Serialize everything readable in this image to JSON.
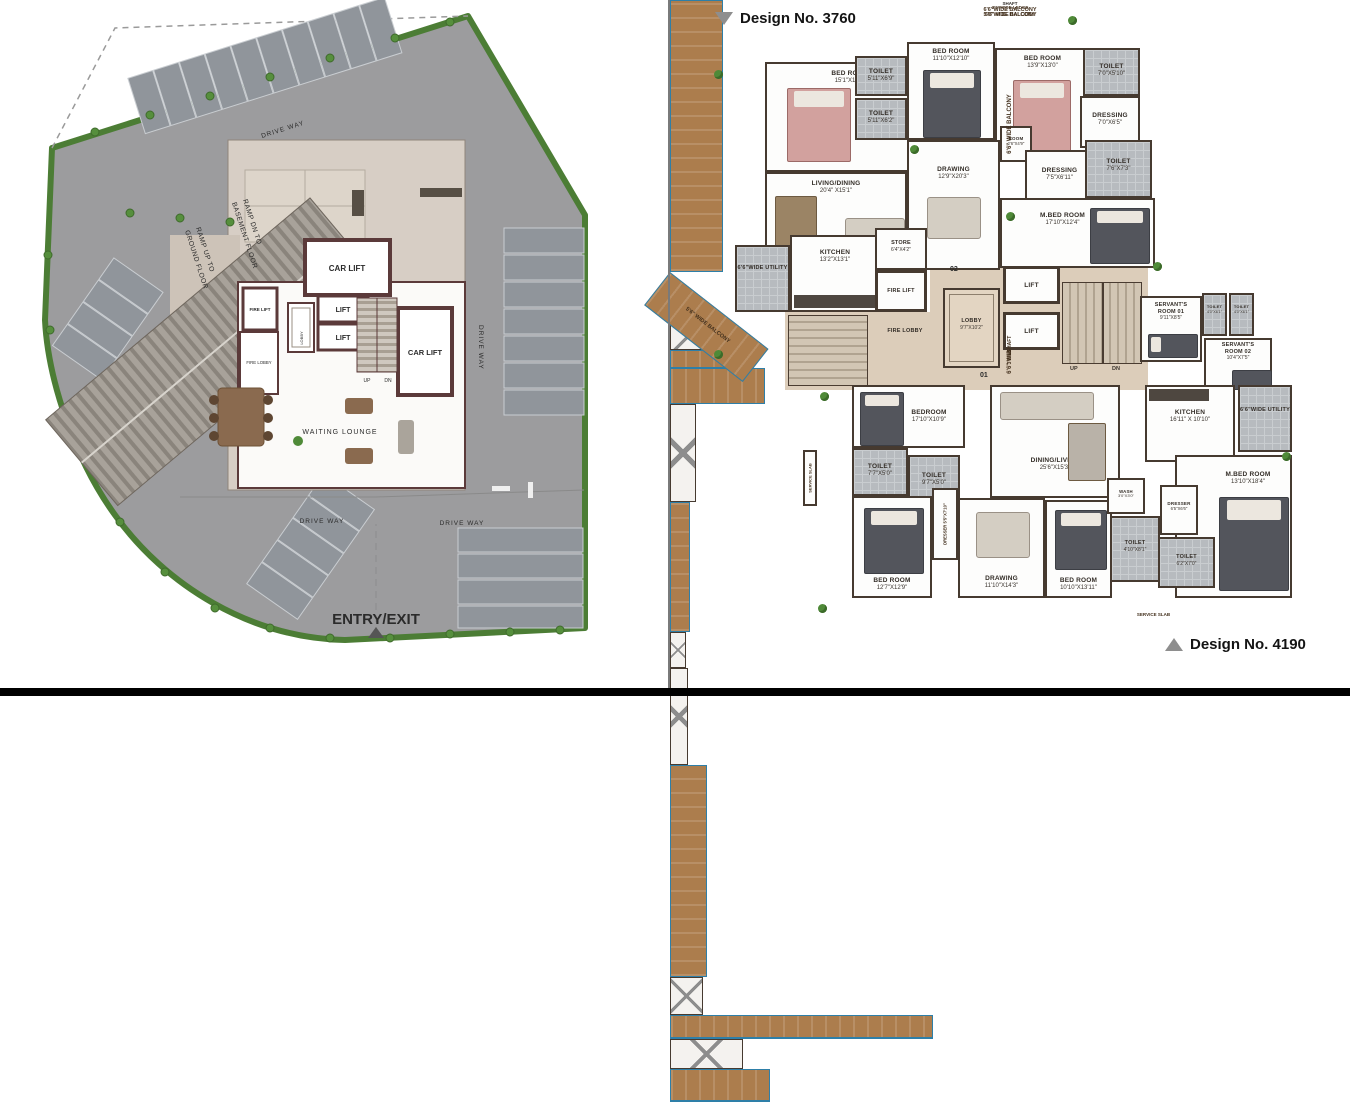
{
  "panels": {
    "design_top": "Design No. 3760",
    "design_bottom": "Design No. 4190"
  },
  "colors": {
    "wall": "#463a30",
    "wood_balcony": "#ac7d4d",
    "balcony_edge_blue": "#2e7fa8",
    "site_gray": "#9c9c9e",
    "hedge_green": "#4c7d35",
    "core_beige": "#dccdba"
  },
  "left_plan": {
    "drive_way_top": "DRIVE WAY",
    "drive_way_right": "DRIVE WAY",
    "drive_way_bottom_left": "DRIVE WAY",
    "drive_way_bottom_right": "DRIVE WAY",
    "ramp_dn_1": "RAMP DN TO",
    "ramp_dn_2": "BASEMENT FLOOR",
    "ramp_up_1": "RAMP UP TO",
    "ramp_up_2": "GROUND FLOOR",
    "car_lift_top": "CAR LIFT",
    "car_lift_right": "CAR LIFT",
    "lift_1": "LIFT",
    "lift_2": "LIFT",
    "fire_lift": "FIRE LIFT",
    "lobby": "LOBBY",
    "fire_lobby": "FIRE LOBBY",
    "waiting_lounge": "WAITING  LOUNGE",
    "up": "UP",
    "dn": "DN",
    "entry_exit": "ENTRY/EXIT"
  },
  "tf": {
    "balcony_left": "6'6\" WIDE BALCONY",
    "balcony_left2": "5'6\" WIDE BALCONY",
    "ledge_top": "3'0\"WIDE LEDGE",
    "balcony_top": "5'0\"WIDE BALCONY",
    "shaft_top": "SHAFT",
    "shaft_right": "SHAFT",
    "ledge_right": "3'0\"WIDE LEDGE",
    "bedroom1": {
      "n": "BED ROOM",
      "d": "15'1\"X13'1\""
    },
    "toilet1": {
      "n": "TOILET",
      "d": "5'11\"X6'9\""
    },
    "toilet2": {
      "n": "TOILET",
      "d": "5'11\"X6'2\""
    },
    "bedroom2": {
      "n": "BED ROOM",
      "d": "11'10\"X12'10\""
    },
    "bedroom3": {
      "n": "BED ROOM",
      "d": "13'9\"X13'0\""
    },
    "toilet3": {
      "n": "TOILET",
      "d": "7'0\"X5'10\""
    },
    "dressing1": {
      "n": "DRESSING",
      "d": "7'0\"X6'5\""
    },
    "living": {
      "n": "LIVING/DINING",
      "d": "20'4\" X15'1\""
    },
    "drawing": {
      "n": "DRAWING",
      "d": "12'9\"X20'3\""
    },
    "room_small": {
      "n": "ROOM",
      "d": "2'6\"X4'9\""
    },
    "dressing2": {
      "n": "DRESSING",
      "d": "7'5\"X6'11\""
    },
    "toilet4": {
      "n": "TOILET",
      "d": "7'6\"X7'3\""
    },
    "mbed": {
      "n": "M.BED ROOM",
      "d": "17'10\"X12'4\""
    },
    "kitchen": {
      "n": "KITCHEN",
      "d": "13'2\"X13'1\""
    },
    "store": {
      "n": "STORE",
      "d": "6'4\"X4'2\""
    },
    "utility": "6'6\"WIDE UTILITY",
    "flat_no": "02"
  },
  "core": {
    "fire_lift": "FIRE LIFT",
    "fire_lobby": "FIRE LOBBY",
    "lobby": {
      "n": "LOBBY",
      "d": "9'7\"X10'2\""
    },
    "lift1": "LIFT",
    "lift2": "LIFT",
    "up": "UP",
    "dn": "DN",
    "elec_shaft": "ELEC. SHAFT",
    "flat_no": "01",
    "servant1": {
      "n": "SERVANT'S",
      "n2": "ROOM 01",
      "d": "9'11\"X8'5\""
    },
    "servant_toilet1": {
      "n": "TOILET",
      "d": "4'0\"X6'1\""
    },
    "servant_toilet2": {
      "n": "TOILET",
      "d": "4'0\"X6'1\""
    },
    "servant2": {
      "n": "SERVANT'S",
      "n2": "ROOM 02",
      "d": "10'4\"X7'5\""
    },
    "shaft": "SHAFT"
  },
  "bf": {
    "bedroom_t": {
      "n": "BEDROOM",
      "d": "17'10\"X10'9\""
    },
    "toilet1": {
      "n": "TOILET",
      "d": "7'7\"X5'0\""
    },
    "toilet2": {
      "n": "TOILET",
      "d": "9'7\"X5'0\""
    },
    "bedroom1": {
      "n": "BED ROOM",
      "d": "12'7\"X12'9\""
    },
    "dresser_v": {
      "n": "DRESSER",
      "d": "5'5\"X7'10\""
    },
    "drawing": {
      "n": "DRAWING",
      "d": "11'10\"X14'3\""
    },
    "dining": {
      "n": "DINING/LIVING",
      "d": "25'6\"X15'3\""
    },
    "bedroom2": {
      "n": "BED ROOM",
      "d": "10'10\"X13'11\""
    },
    "kitchen": {
      "n": "KITCHEN",
      "d": "16'11\" X 10'10\""
    },
    "utility": "6'6\"WIDE UTILITY",
    "wash": {
      "n": "WASH",
      "d": "3'0\"X3'0\""
    },
    "dresser": {
      "n": "DRESSER",
      "d": "6'5\"X6'6\""
    },
    "mbed": {
      "n": "M.BED ROOM",
      "d": "13'10\"X18'4\""
    },
    "toilet3": {
      "n": "TOILET",
      "d": "4'10\"X8'1\""
    },
    "toilet4": {
      "n": "TOILET",
      "d": "6'2\"X7'0\""
    },
    "balcony_left": "6'6\" WIDE BALCONY",
    "service_slab_left": "SERVICE SLAB",
    "balcony_bottom": "6'6\"WIDE BALCONY",
    "service_slab_bottom": "SERVICE SLAB",
    "balcony_bottom_right": "6'6\" WIDE BALCONY"
  }
}
